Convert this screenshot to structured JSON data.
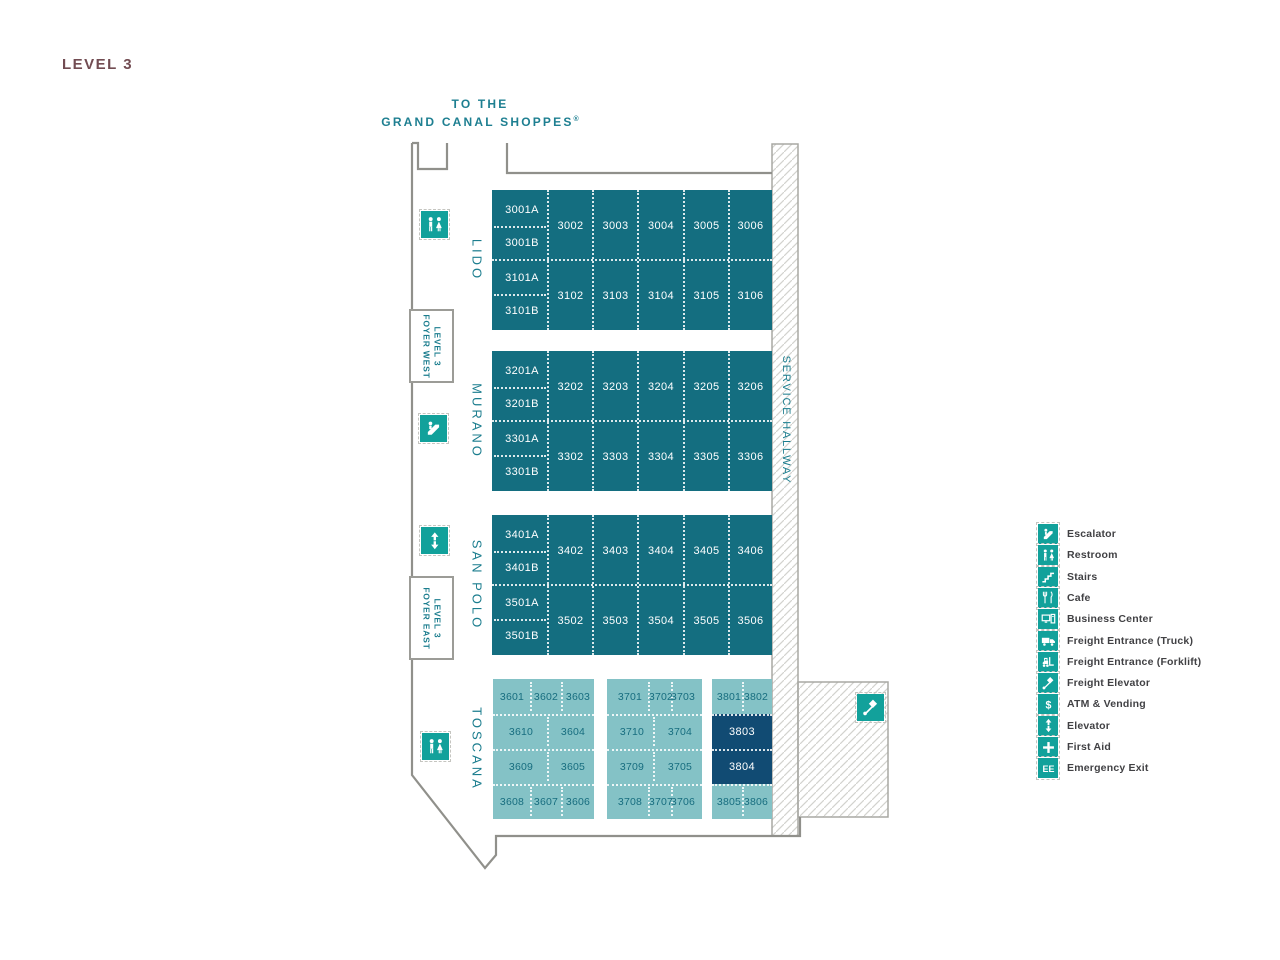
{
  "title": "LEVEL 3",
  "entrance": {
    "line1": "TO THE",
    "line2": "GRAND CANAL SHOPPES",
    "mark": "®"
  },
  "service_hallway": "SERVICE HALLWAY",
  "foyers": [
    {
      "line1": "LEVEL 3",
      "line2": "FOYER WEST"
    },
    {
      "line1": "LEVEL 3",
      "line2": "FOYER EAST"
    }
  ],
  "sections": [
    {
      "name": "LIDO",
      "hall_rooms": [
        "3001A",
        "3001B",
        "3101A",
        "3101B"
      ],
      "rows": [
        [
          "3002",
          "3003",
          "3004",
          "3005",
          "3006"
        ],
        [
          "3102",
          "3103",
          "3104",
          "3105",
          "3106"
        ]
      ]
    },
    {
      "name": "MURANO",
      "hall_rooms": [
        "3201A",
        "3201B",
        "3301A",
        "3301B"
      ],
      "rows": [
        [
          "3202",
          "3203",
          "3204",
          "3205",
          "3206"
        ],
        [
          "3302",
          "3303",
          "3304",
          "3305",
          "3306"
        ]
      ]
    },
    {
      "name": "SAN POLO",
      "hall_rooms": [
        "3401A",
        "3401B",
        "3501A",
        "3501B"
      ],
      "rows": [
        [
          "3402",
          "3403",
          "3404",
          "3405",
          "3406"
        ],
        [
          "3502",
          "3503",
          "3504",
          "3505",
          "3506"
        ]
      ]
    }
  ],
  "toscana": {
    "name": "TOSCANA",
    "blocks": [
      {
        "rows": [
          [
            "3601",
            "3602",
            "3603"
          ],
          [
            "3610",
            "3604"
          ],
          [
            "3609",
            "3605"
          ],
          [
            "3608",
            "3607",
            "3606"
          ]
        ],
        "dark_rows": []
      },
      {
        "rows": [
          [
            "3701",
            "3702",
            "3703"
          ],
          [
            "3710",
            "3704"
          ],
          [
            "3709",
            "3705"
          ],
          [
            "3708",
            "3707",
            "3706"
          ]
        ],
        "dark_rows": []
      },
      {
        "rows": [
          [
            "3801",
            "3802"
          ],
          [
            "3803"
          ],
          [
            "3804"
          ],
          [
            "3805",
            "3806"
          ]
        ],
        "dark_rows": [
          1,
          2
        ]
      }
    ]
  },
  "map_icons": [
    "restroom",
    "escalator",
    "elevator",
    "restroom",
    "freight-elevator"
  ],
  "legend": [
    {
      "icon": "escalator",
      "label": "Escalator"
    },
    {
      "icon": "restroom",
      "label": "Restroom"
    },
    {
      "icon": "stairs",
      "label": "Stairs"
    },
    {
      "icon": "cafe",
      "label": "Cafe"
    },
    {
      "icon": "business-center",
      "label": "Business Center"
    },
    {
      "icon": "freight-truck",
      "label": "Freight Entrance (Truck)"
    },
    {
      "icon": "freight-forklift",
      "label": "Freight Entrance (Forklift)"
    },
    {
      "icon": "freight-elevator",
      "label": "Freight Elevator"
    },
    {
      "icon": "atm",
      "label": "ATM & Vending"
    },
    {
      "icon": "elevator",
      "label": "Elevator"
    },
    {
      "icon": "first-aid",
      "label": "First Aid"
    },
    {
      "icon": "emergency-exit",
      "label": "Emergency Exit"
    }
  ],
  "colors": {
    "room_block": "#146E80",
    "room_block_light": "#84C2C6",
    "room_block_navy": "#114B73",
    "icon_teal": "#12A19B",
    "text_teal": "#1B7D8E",
    "title_color": "#724C52",
    "legend_text": "#414144",
    "wall_gray": "#90908B"
  }
}
